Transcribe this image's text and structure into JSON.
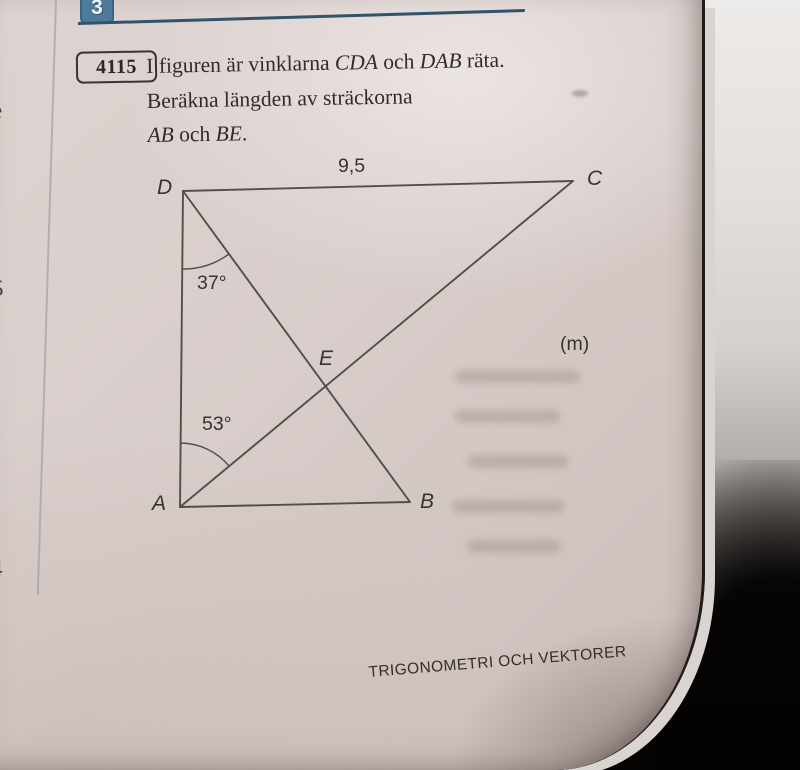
{
  "header": {
    "chapter_number": "3"
  },
  "problem": {
    "number": "4115",
    "line1_pre": "I figuren är vinklarna ",
    "line1_it1": "CDA",
    "line1_mid": " och ",
    "line1_it2": "DAB",
    "line1_post": " räta.",
    "line2": "Beräkna längden av sträckorna",
    "line3_it1": "AB",
    "line3_mid": " och ",
    "line3_it2": "BE",
    "line3_post": "."
  },
  "figure": {
    "top_length_label": "9,5",
    "unit_label": "(m)",
    "angle_at_d": "37°",
    "angle_at_a": "53°",
    "points": {
      "d": "D",
      "c": "C",
      "a": "A",
      "b": "B",
      "e": "E"
    }
  },
  "margin": {
    "letter_top": "e",
    "letter_mid": "5",
    "letter_bottom": "4"
  },
  "footer": {
    "text": "TRIGONOMETRI OCH VEKTORER"
  },
  "colors": {
    "chapter_badge": "#4d7c9b",
    "chapter_rule": "#31536b",
    "figure_lines": "#554e47",
    "page_paper": "#d6cbc8"
  }
}
